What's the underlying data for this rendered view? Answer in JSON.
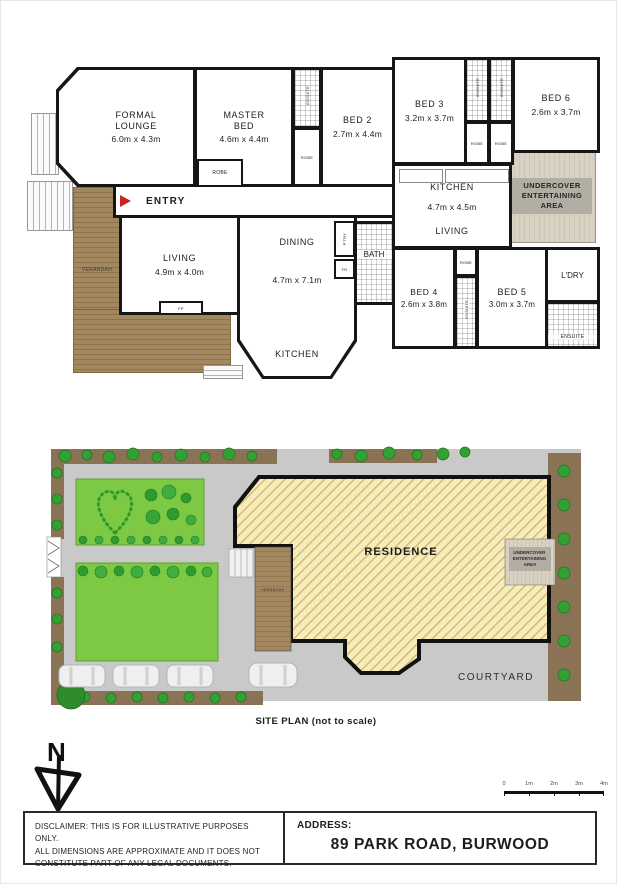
{
  "floor_plan": {
    "rooms": {
      "formal_lounge": {
        "name": "FORMAL LOUNGE",
        "dims": "6.0m x 4.3m"
      },
      "master_bed": {
        "name": "MASTER BED",
        "dims": "4.6m x 4.4m"
      },
      "bed_2": {
        "name": "BED 2",
        "dims": "2.7m x 4.4m"
      },
      "bed_3": {
        "name": "BED 3",
        "dims": "3.2m x 3.7m"
      },
      "bed_4": {
        "name": "BED 4",
        "dims": "2.6m x 3.8m"
      },
      "bed_5": {
        "name": "BED 5",
        "dims": "3.0m x 3.7m"
      },
      "bed_6": {
        "name": "BED 6",
        "dims": "2.6m x 3.7m"
      },
      "kitchen_upper": {
        "name": "KITCHEN",
        "dims": "4.7m x 4.5m"
      },
      "living_upper": {
        "name": "LIVING"
      },
      "entry": {
        "name": "ENTRY"
      },
      "living_main": {
        "name": "LIVING",
        "dims": "4.9m x 4.0m"
      },
      "dining": {
        "name": "DINING",
        "dims": "4.7m x 7.1m"
      },
      "kitchen_main": {
        "name": "KITCHEN"
      },
      "bath": {
        "name": "BATH"
      },
      "laundry": {
        "name": "L'DRY"
      },
      "verandah": {
        "name": "VERANDAH"
      },
      "undercover": {
        "name": "UNDERCOVER ENTERTAINING AREA"
      }
    },
    "fixtures": {
      "robe": "ROBE",
      "ensuite": "ENSUITE",
      "pantry": "P'TRY",
      "fridge": "FR",
      "fireplace": "FP"
    }
  },
  "site_plan": {
    "residence_label": "RESIDENCE",
    "courtyard_label": "COURTYARD",
    "verandah_label": "VERANDAH",
    "undercover_lines": [
      "UNDERCOVER",
      "ENTERTAINING",
      "AREA"
    ],
    "caption": "SITE PLAN (not to scale)"
  },
  "compass": {
    "label": "N"
  },
  "scale_bar": {
    "ticks": [
      "0",
      "1m",
      "2m",
      "3m",
      "4m"
    ]
  },
  "footer": {
    "disclaimer_lines": [
      "DISCLAIMER: THIS IS FOR ILLUSTRATIVE PURPOSES ONLY.",
      "ALL DIMENSIONS ARE APPROXIMATE AND IT DOES NOT",
      "CONSTITUTE PART OF ANY LEGAL DOCUMENTS."
    ],
    "address_label": "ADDRESS:",
    "address": "89 PARK ROAD, BURWOOD"
  },
  "colors": {
    "wall": "#161616",
    "entry_arrow": "#cc2222",
    "verandah_deck": "#a3885f",
    "undercover_deck": "#d9d2c2",
    "undercover_label_bg": "#b3aea4",
    "driveway": "#c9c9c9",
    "garden_bed": "#8a7254",
    "lawn": "#7dc944",
    "tree": "#33a033",
    "residence_fill": "#f5ecc0",
    "residence_hatch": "#d9bd66"
  }
}
